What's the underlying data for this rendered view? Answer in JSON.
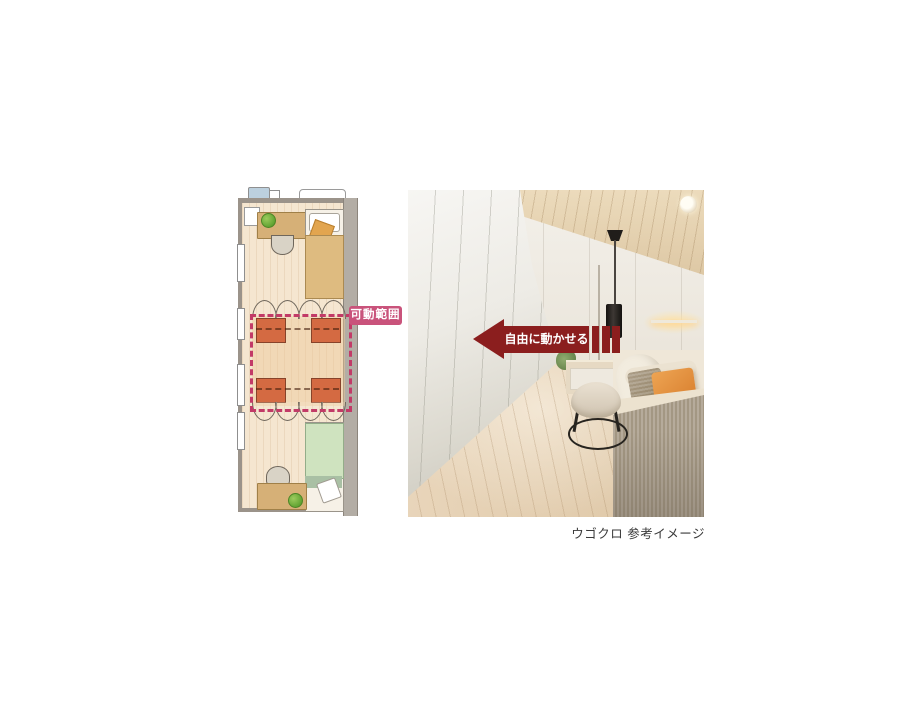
{
  "annotations": {
    "range_label": "可動範囲",
    "arrow_label": "自由に動かせる"
  },
  "caption": {
    "text": "ウゴクロ 参考イメージ"
  },
  "colors": {
    "arrow_red": "#8b1e1e",
    "range_label_pink": "#c9537b",
    "range_dashed_pink": "#c23a67",
    "wardrobe_orange": "#d46a42",
    "plan_floor_beige": "#f5e6d0",
    "bed_blanket_tan": "#debb80",
    "bed_blanket_green": "#cfe3bf",
    "desk_wood": "#d6b077",
    "wall_gray": "#9b938a"
  },
  "floor_plan": {
    "description": "Long narrow room plan: bed and desk at top, four movable wardrobe units with door-swing arcs in the centre inside a pink dashed movable-range boundary, bed and desk at bottom, windows on the left wall"
  },
  "photo": {
    "description": "Bedroom with tall white movable-closet panels on the left, wooden sloped ceiling, wooden floor, dressing table with round stool, pendant light and a bed with orange pillow and grey striped throw"
  }
}
